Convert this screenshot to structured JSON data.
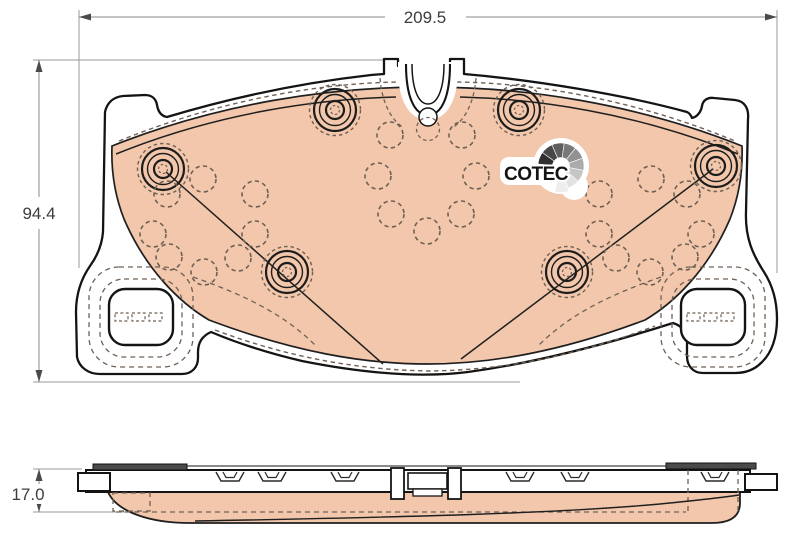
{
  "title": "brake-pad-technical-drawing",
  "dims": {
    "width": "209.5",
    "height": "94.4",
    "thickness": "17.0"
  },
  "logo": {
    "text": "COTEC",
    "icon": "cotec-fan-gauge-icon",
    "fan_shades": [
      "#2f2f2f",
      "#474747",
      "#5e5e5e",
      "#787878",
      "#929292",
      "#ababab",
      "#c6c6c6",
      "#e2e2e2",
      "#ededed"
    ]
  },
  "colors": {
    "friction": "#f2c7ab",
    "outline": "#141414",
    "dashed": "#6f6156",
    "dimension_line": "#8a8a8a",
    "extension_line": "#9a9a9a",
    "dimension_text": "#3d3d3d",
    "arrow": "#4a4a4a",
    "shim_dark": "#4a4a4a",
    "background": "#ffffff"
  },
  "rivets": [
    [
      163,
      169
    ],
    [
      335,
      110
    ],
    [
      519,
      110
    ],
    [
      716,
      166
    ],
    [
      287,
      272
    ],
    [
      567,
      272
    ]
  ],
  "holes": [
    [
      390,
      135
    ],
    [
      462,
      135
    ],
    [
      378,
      176
    ],
    [
      476,
      176
    ],
    [
      391,
      214
    ],
    [
      461,
      214
    ],
    [
      427,
      231
    ],
    [
      203,
      179
    ],
    [
      167,
      194
    ],
    [
      255,
      194
    ],
    [
      153,
      234
    ],
    [
      255,
      234
    ],
    [
      169,
      257
    ],
    [
      238,
      258
    ],
    [
      204,
      272
    ],
    [
      651,
      179
    ],
    [
      687,
      194
    ],
    [
      599,
      194
    ],
    [
      701,
      234
    ],
    [
      599,
      234
    ],
    [
      685,
      257
    ],
    [
      616,
      258
    ],
    [
      650,
      272
    ]
  ]
}
